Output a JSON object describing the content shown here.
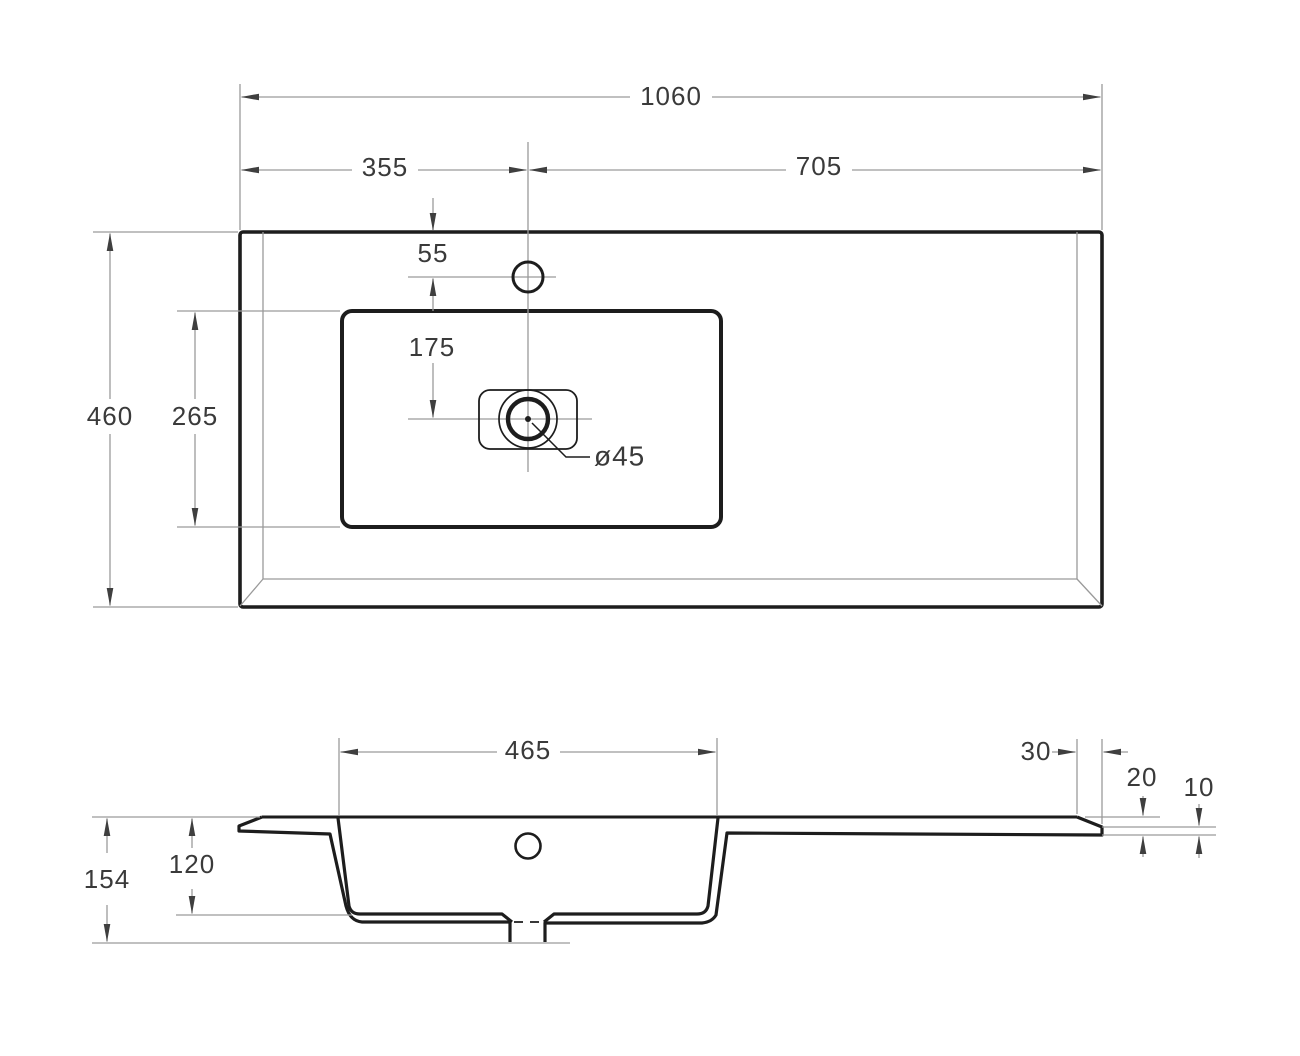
{
  "drawing": {
    "background": "#ffffff",
    "line_color": "#1d1d1d",
    "thin_line_color": "#9a9a9a",
    "text_color": "#3a3a3a",
    "views": {
      "plan": {
        "name": "top-view-plan",
        "dims": {
          "overall_width": "1060",
          "faucet_offset_left": "355",
          "faucet_offset_right": "705",
          "top_edge_to_faucet": "55",
          "faucet_to_drain": "175",
          "basin_depth": "265",
          "overall_depth": "460",
          "drain_diameter": "ø45"
        }
      },
      "section": {
        "name": "front-section-view",
        "dims": {
          "basin_width": "465",
          "edge_chamfer": "30",
          "edge_thickness": "20",
          "lip_thickness": "10",
          "basin_inner_depth": "120",
          "overall_height": "154"
        }
      }
    }
  }
}
